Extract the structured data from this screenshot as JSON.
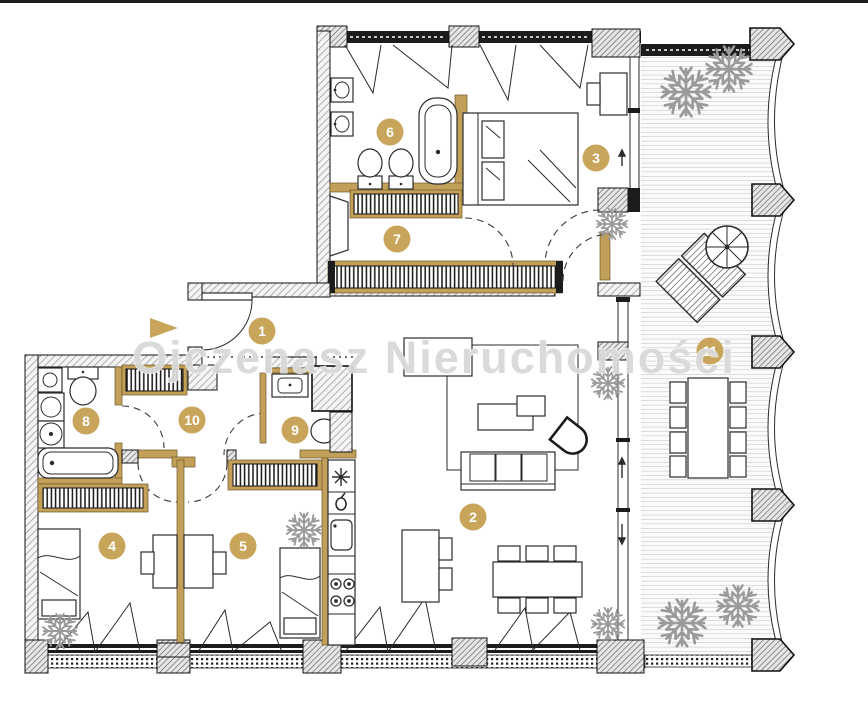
{
  "watermark": {
    "text": "Ojczenasz Nieruchomości",
    "color": "#d9d9d9"
  },
  "room_markers": [
    {
      "number": "1",
      "x": 262,
      "y": 331
    },
    {
      "number": "2",
      "x": 473,
      "y": 517
    },
    {
      "number": "3",
      "x": 596,
      "y": 158
    },
    {
      "number": "4",
      "x": 112,
      "y": 546
    },
    {
      "number": "5",
      "x": 243,
      "y": 546
    },
    {
      "number": "6",
      "x": 390,
      "y": 132
    },
    {
      "number": "7",
      "x": 397,
      "y": 239
    },
    {
      "number": "8",
      "x": 86,
      "y": 421
    },
    {
      "number": "9",
      "x": 295,
      "y": 430
    },
    {
      "number": "10",
      "x": 192,
      "y": 420
    },
    {
      "number": "11",
      "x": 710,
      "y": 351
    }
  ],
  "colors": {
    "accent_gold": "#c9a55b",
    "wood_wall": "#c2a05a",
    "wall_black": "#1c1c1c",
    "hatch_line": "#8c8c8c",
    "deck_line": "#bcbcbc",
    "plant": "#9a9a9a"
  }
}
